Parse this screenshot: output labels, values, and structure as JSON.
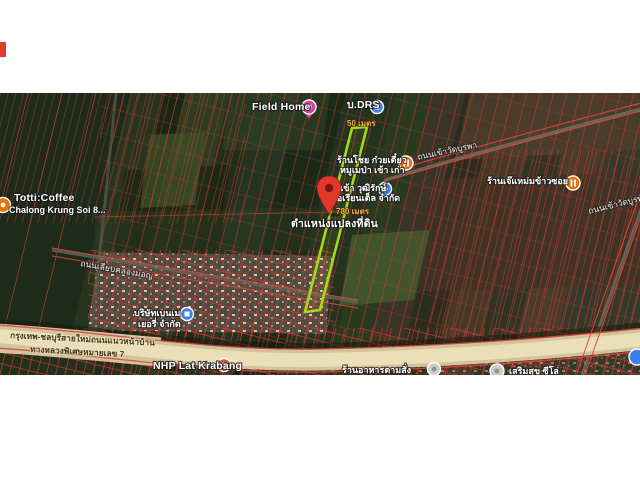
{
  "map": {
    "kind": "satellite-cadastral-map",
    "parcel": {
      "label": "ตำแหน่งแปลงที่ดิน",
      "top_measure": "50 เมตร",
      "side_measure": "780 เมตร"
    },
    "pois": [
      {
        "name": "Field Home"
      },
      {
        "name": "บ.DRS"
      },
      {
        "name": "ร้านโชย ก๋วยเตี๋ยว",
        "name2": "หมูเมป่า เข้า เก่า"
      },
      {
        "name": "น้ำเข้า วุฒิรักษ์",
        "name2": "โอเรียนเต็ล จำกัด"
      },
      {
        "name": "ร้านเจ๊แหม่มข้าวซอย"
      },
      {
        "name": "Totti:Coffee",
        "name2": "Chalong Krung Soi 8..."
      },
      {
        "name": "บริษัทเบนเม",
        "name2": "เยอรี่ จำกัด"
      },
      {
        "name": "NHP Lat Krabang"
      },
      {
        "name": "ร้านอาหารตามสั่ง"
      },
      {
        "name": "เสริมสุข ซีโล่"
      }
    ],
    "roads": [
      {
        "name": "ถนนเข้าวัดบูรพา"
      },
      {
        "name": "ถนนเข้าวัดบูรพา"
      },
      {
        "name": "ถนนเลียบคลองมอญ"
      },
      {
        "name": "กรุงเทพ-ชลบุรีสายใหม่ถนนแนวหน้าบ้าน"
      },
      {
        "name": "ทางหลวงพิเศษหมายเลข 7"
      }
    ],
    "colors": {
      "parcel_outline": "#a6d818",
      "cadastral_line": "#d23a30",
      "pin": "#e2372b",
      "measure_text": "#f6ad3c",
      "poi_orange": "#e8710a",
      "poi_blue": "#3d7ef0",
      "poi_pink": "#e13a9d",
      "poi_red": "#dd4b39",
      "poi_gray": "#c9cdc4",
      "motorway": "#e7dcb6"
    }
  }
}
